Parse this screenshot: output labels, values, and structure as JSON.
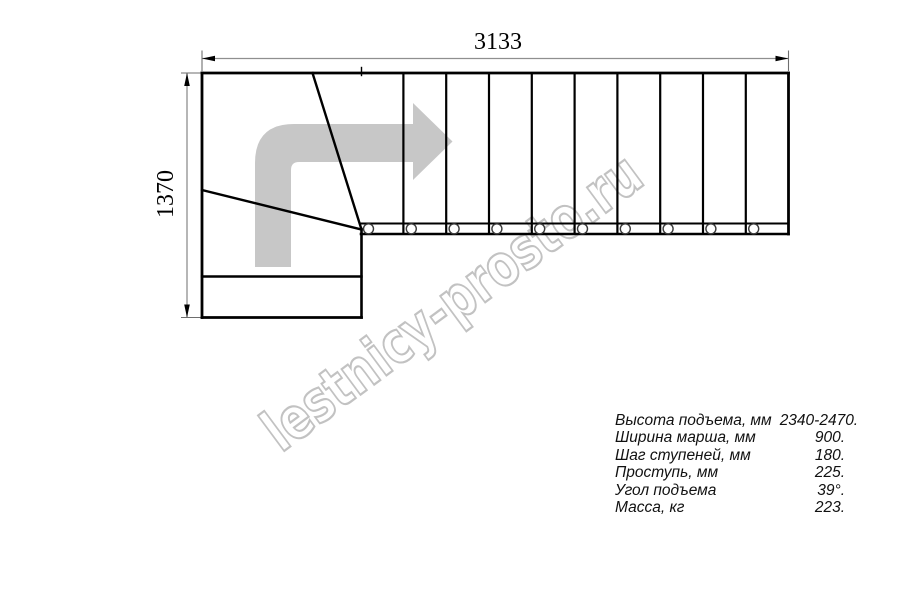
{
  "drawing": {
    "type": "staircase-plan-top-view",
    "top_dimension": "3133",
    "left_dimension": "1370",
    "straight_flight_steps": 10,
    "baluster_circles": 10,
    "winder_steps": 3
  },
  "watermark": {
    "text": "lestnicy-prosto.ru"
  },
  "specs": {
    "rows": [
      {
        "label": "Высота подъема, мм",
        "value": "2340-2470."
      },
      {
        "label": "Ширина марша, мм",
        "value": "900."
      },
      {
        "label": "Шаг ступеней, мм",
        "value": "180."
      },
      {
        "label": "Проступь, мм",
        "value": "225."
      },
      {
        "label": "Угол подъема",
        "value": "39°."
      },
      {
        "label": "Масса, кг",
        "value": "223."
      }
    ]
  },
  "colors": {
    "background": "#ffffff",
    "line": "#000000",
    "dimension_line": "#8f8f8f",
    "direction_arrow": "#c7c7c7",
    "watermark_outline": "#c2c2c2"
  }
}
